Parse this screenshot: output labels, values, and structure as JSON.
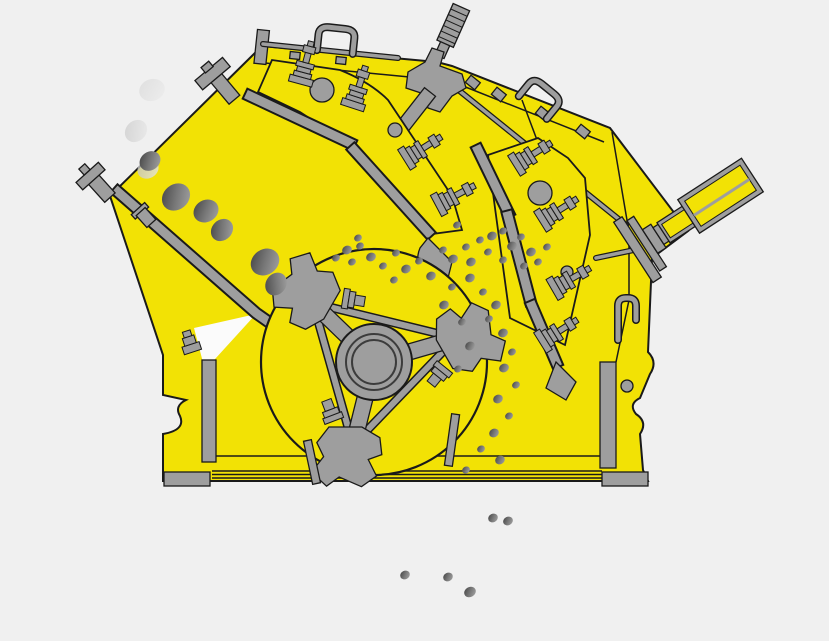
{
  "diagram": {
    "subject": "impact-crusher-cutaway"
  },
  "colors": {
    "background": "#f0f0f0",
    "body_yellow": "#f2e205",
    "outline": "#1a1a1a",
    "metal_gray": "#9e9e9e",
    "metal_gray_dark": "#8a8a8a",
    "feed_opening": "#fbfbfb",
    "rock_dark": "#3f3f3f",
    "rock_mid": "#777777",
    "rock_light": "#a8a8a8",
    "rock_faint_dark": "#bfbfbf",
    "rock_faint_light": "#e8e8e8"
  },
  "rocks": {
    "feed_faint": [
      {
        "x": 152,
        "y": 90,
        "r": 13,
        "rot": -20,
        "op": 0.35
      },
      {
        "x": 136,
        "y": 131,
        "r": 12,
        "rot": -45,
        "op": 0.6
      },
      {
        "x": 148,
        "y": 169,
        "r": 11,
        "rot": -30,
        "op": 0.8
      }
    ],
    "feed_chute": [
      {
        "x": 150,
        "y": 161,
        "r": 11,
        "rot": -35
      },
      {
        "x": 176,
        "y": 197,
        "r": 15,
        "rot": -40
      },
      {
        "x": 206,
        "y": 211,
        "r": 13,
        "rot": -30
      },
      {
        "x": 222,
        "y": 230,
        "r": 12,
        "rot": -45
      },
      {
        "x": 265,
        "y": 262,
        "r": 15,
        "rot": -35
      },
      {
        "x": 276,
        "y": 284,
        "r": 12,
        "rot": -55
      }
    ],
    "interior": [
      {
        "x": 347,
        "y": 250,
        "r": 5
      },
      {
        "x": 360,
        "y": 246,
        "r": 4
      },
      {
        "x": 352,
        "y": 262,
        "r": 4
      },
      {
        "x": 371,
        "y": 257,
        "r": 5
      },
      {
        "x": 383,
        "y": 266,
        "r": 4
      },
      {
        "x": 396,
        "y": 253,
        "r": 4
      },
      {
        "x": 406,
        "y": 269,
        "r": 5
      },
      {
        "x": 394,
        "y": 280,
        "r": 4
      },
      {
        "x": 419,
        "y": 261,
        "r": 4
      },
      {
        "x": 431,
        "y": 276,
        "r": 5
      },
      {
        "x": 443,
        "y": 250,
        "r": 4
      },
      {
        "x": 453,
        "y": 259,
        "r": 5
      },
      {
        "x": 466,
        "y": 247,
        "r": 4
      },
      {
        "x": 471,
        "y": 262,
        "r": 5
      },
      {
        "x": 480,
        "y": 240,
        "r": 4
      },
      {
        "x": 492,
        "y": 236,
        "r": 5
      },
      {
        "x": 488,
        "y": 252,
        "r": 4
      },
      {
        "x": 503,
        "y": 231,
        "r": 4
      },
      {
        "x": 512,
        "y": 246,
        "r": 5
      },
      {
        "x": 503,
        "y": 260,
        "r": 4
      },
      {
        "x": 521,
        "y": 237,
        "r": 4
      },
      {
        "x": 531,
        "y": 252,
        "r": 5
      },
      {
        "x": 524,
        "y": 266,
        "r": 4
      },
      {
        "x": 538,
        "y": 262,
        "r": 4
      },
      {
        "x": 547,
        "y": 247,
        "r": 4
      },
      {
        "x": 457,
        "y": 225,
        "r": 4
      },
      {
        "x": 470,
        "y": 278,
        "r": 5
      },
      {
        "x": 483,
        "y": 292,
        "r": 4
      },
      {
        "x": 496,
        "y": 305,
        "r": 5
      },
      {
        "x": 489,
        "y": 319,
        "r": 4
      },
      {
        "x": 503,
        "y": 333,
        "r": 5
      },
      {
        "x": 512,
        "y": 352,
        "r": 4
      },
      {
        "x": 504,
        "y": 368,
        "r": 5
      },
      {
        "x": 516,
        "y": 385,
        "r": 4
      },
      {
        "x": 498,
        "y": 399,
        "r": 5
      },
      {
        "x": 509,
        "y": 416,
        "r": 4
      },
      {
        "x": 494,
        "y": 433,
        "r": 5
      },
      {
        "x": 481,
        "y": 449,
        "r": 4
      },
      {
        "x": 500,
        "y": 460,
        "r": 5
      },
      {
        "x": 466,
        "y": 470,
        "r": 4
      },
      {
        "x": 452,
        "y": 287,
        "r": 4
      },
      {
        "x": 444,
        "y": 305,
        "r": 5
      },
      {
        "x": 462,
        "y": 322,
        "r": 4
      },
      {
        "x": 470,
        "y": 346,
        "r": 5
      },
      {
        "x": 458,
        "y": 369,
        "r": 4
      },
      {
        "x": 358,
        "y": 238,
        "r": 4
      },
      {
        "x": 336,
        "y": 258,
        "r": 4
      }
    ],
    "discharge": [
      {
        "x": 493,
        "y": 518,
        "r": 5
      },
      {
        "x": 508,
        "y": 521,
        "r": 5
      },
      {
        "x": 405,
        "y": 575,
        "r": 5
      },
      {
        "x": 448,
        "y": 577,
        "r": 5
      },
      {
        "x": 470,
        "y": 592,
        "r": 6
      }
    ]
  }
}
